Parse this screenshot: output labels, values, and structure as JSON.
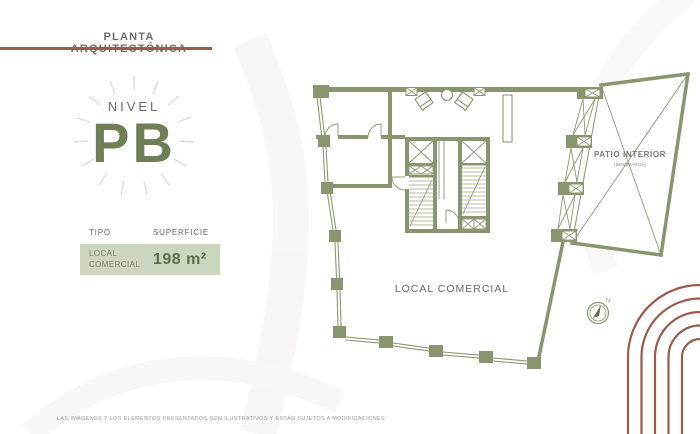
{
  "slide": {
    "header": {
      "title": "PLANTA ARQUITECTÓNICA"
    },
    "level": {
      "label": "NIVEL",
      "code": "PB"
    },
    "table": {
      "col_tipo": "TIPO",
      "col_superficie": "SUPERFICIE",
      "row": {
        "tipo": "LOCAL COMERCIAL",
        "superficie": "198 m²"
      }
    },
    "plan": {
      "label_local": "LOCAL COMERCIAL",
      "label_patio": "PATIO INTERIOR",
      "label_patio_sub": "(DINAMARCA)",
      "compass_n": "N"
    },
    "footer": {
      "disclaimer": "LAS IMÁGENES Y LOS ELEMENTOS PRESENTADOS SON ILUSTRATIVOS Y ESTÁN SUJETOS A MODIFICACIONES"
    },
    "colors": {
      "accent_brick": "#9a5b4a",
      "wall_green": "#88956f",
      "level_green": "#6f7e55",
      "value_green": "#5e7047",
      "table_row_bg": "#ccd5bd"
    }
  }
}
